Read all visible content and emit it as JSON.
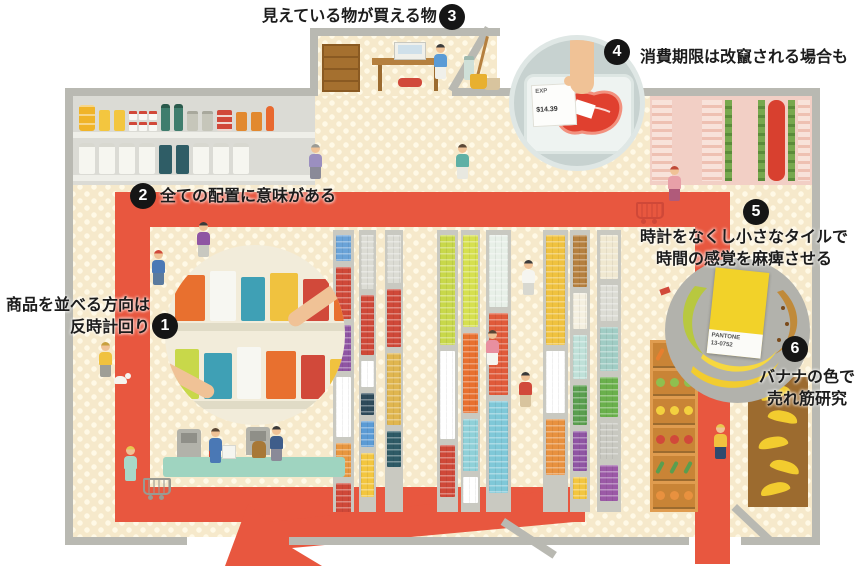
{
  "callouts": [
    {
      "number": "1",
      "lines": [
        "商品を並べる方向は",
        "反時計回り"
      ]
    },
    {
      "number": "2",
      "lines": [
        "全ての配置に意味がある"
      ]
    },
    {
      "number": "3",
      "lines": [
        "見えている物が買える物"
      ]
    },
    {
      "number": "4",
      "lines": [
        "消費期限は改竄される場合も"
      ]
    },
    {
      "number": "5",
      "lines": [
        "時計をなくし小さなタイルで",
        "時間の感覚を麻痺させる"
      ]
    },
    {
      "number": "6",
      "lines": [
        "バナナの色で",
        "売れ筋研究"
      ]
    }
  ],
  "insets": {
    "meat_price_label": {
      "line1": "EXP",
      "line2": "$14.39"
    },
    "pantone_card": {
      "brand": "PANTONE",
      "code": "13-0752"
    }
  },
  "colors": {
    "path_red": "#e8573f",
    "wall_gray": "#b9b9b2",
    "floor_cream": "#f6e9cb",
    "badge_black": "#151515",
    "banana_yellow": "#f2d229"
  }
}
